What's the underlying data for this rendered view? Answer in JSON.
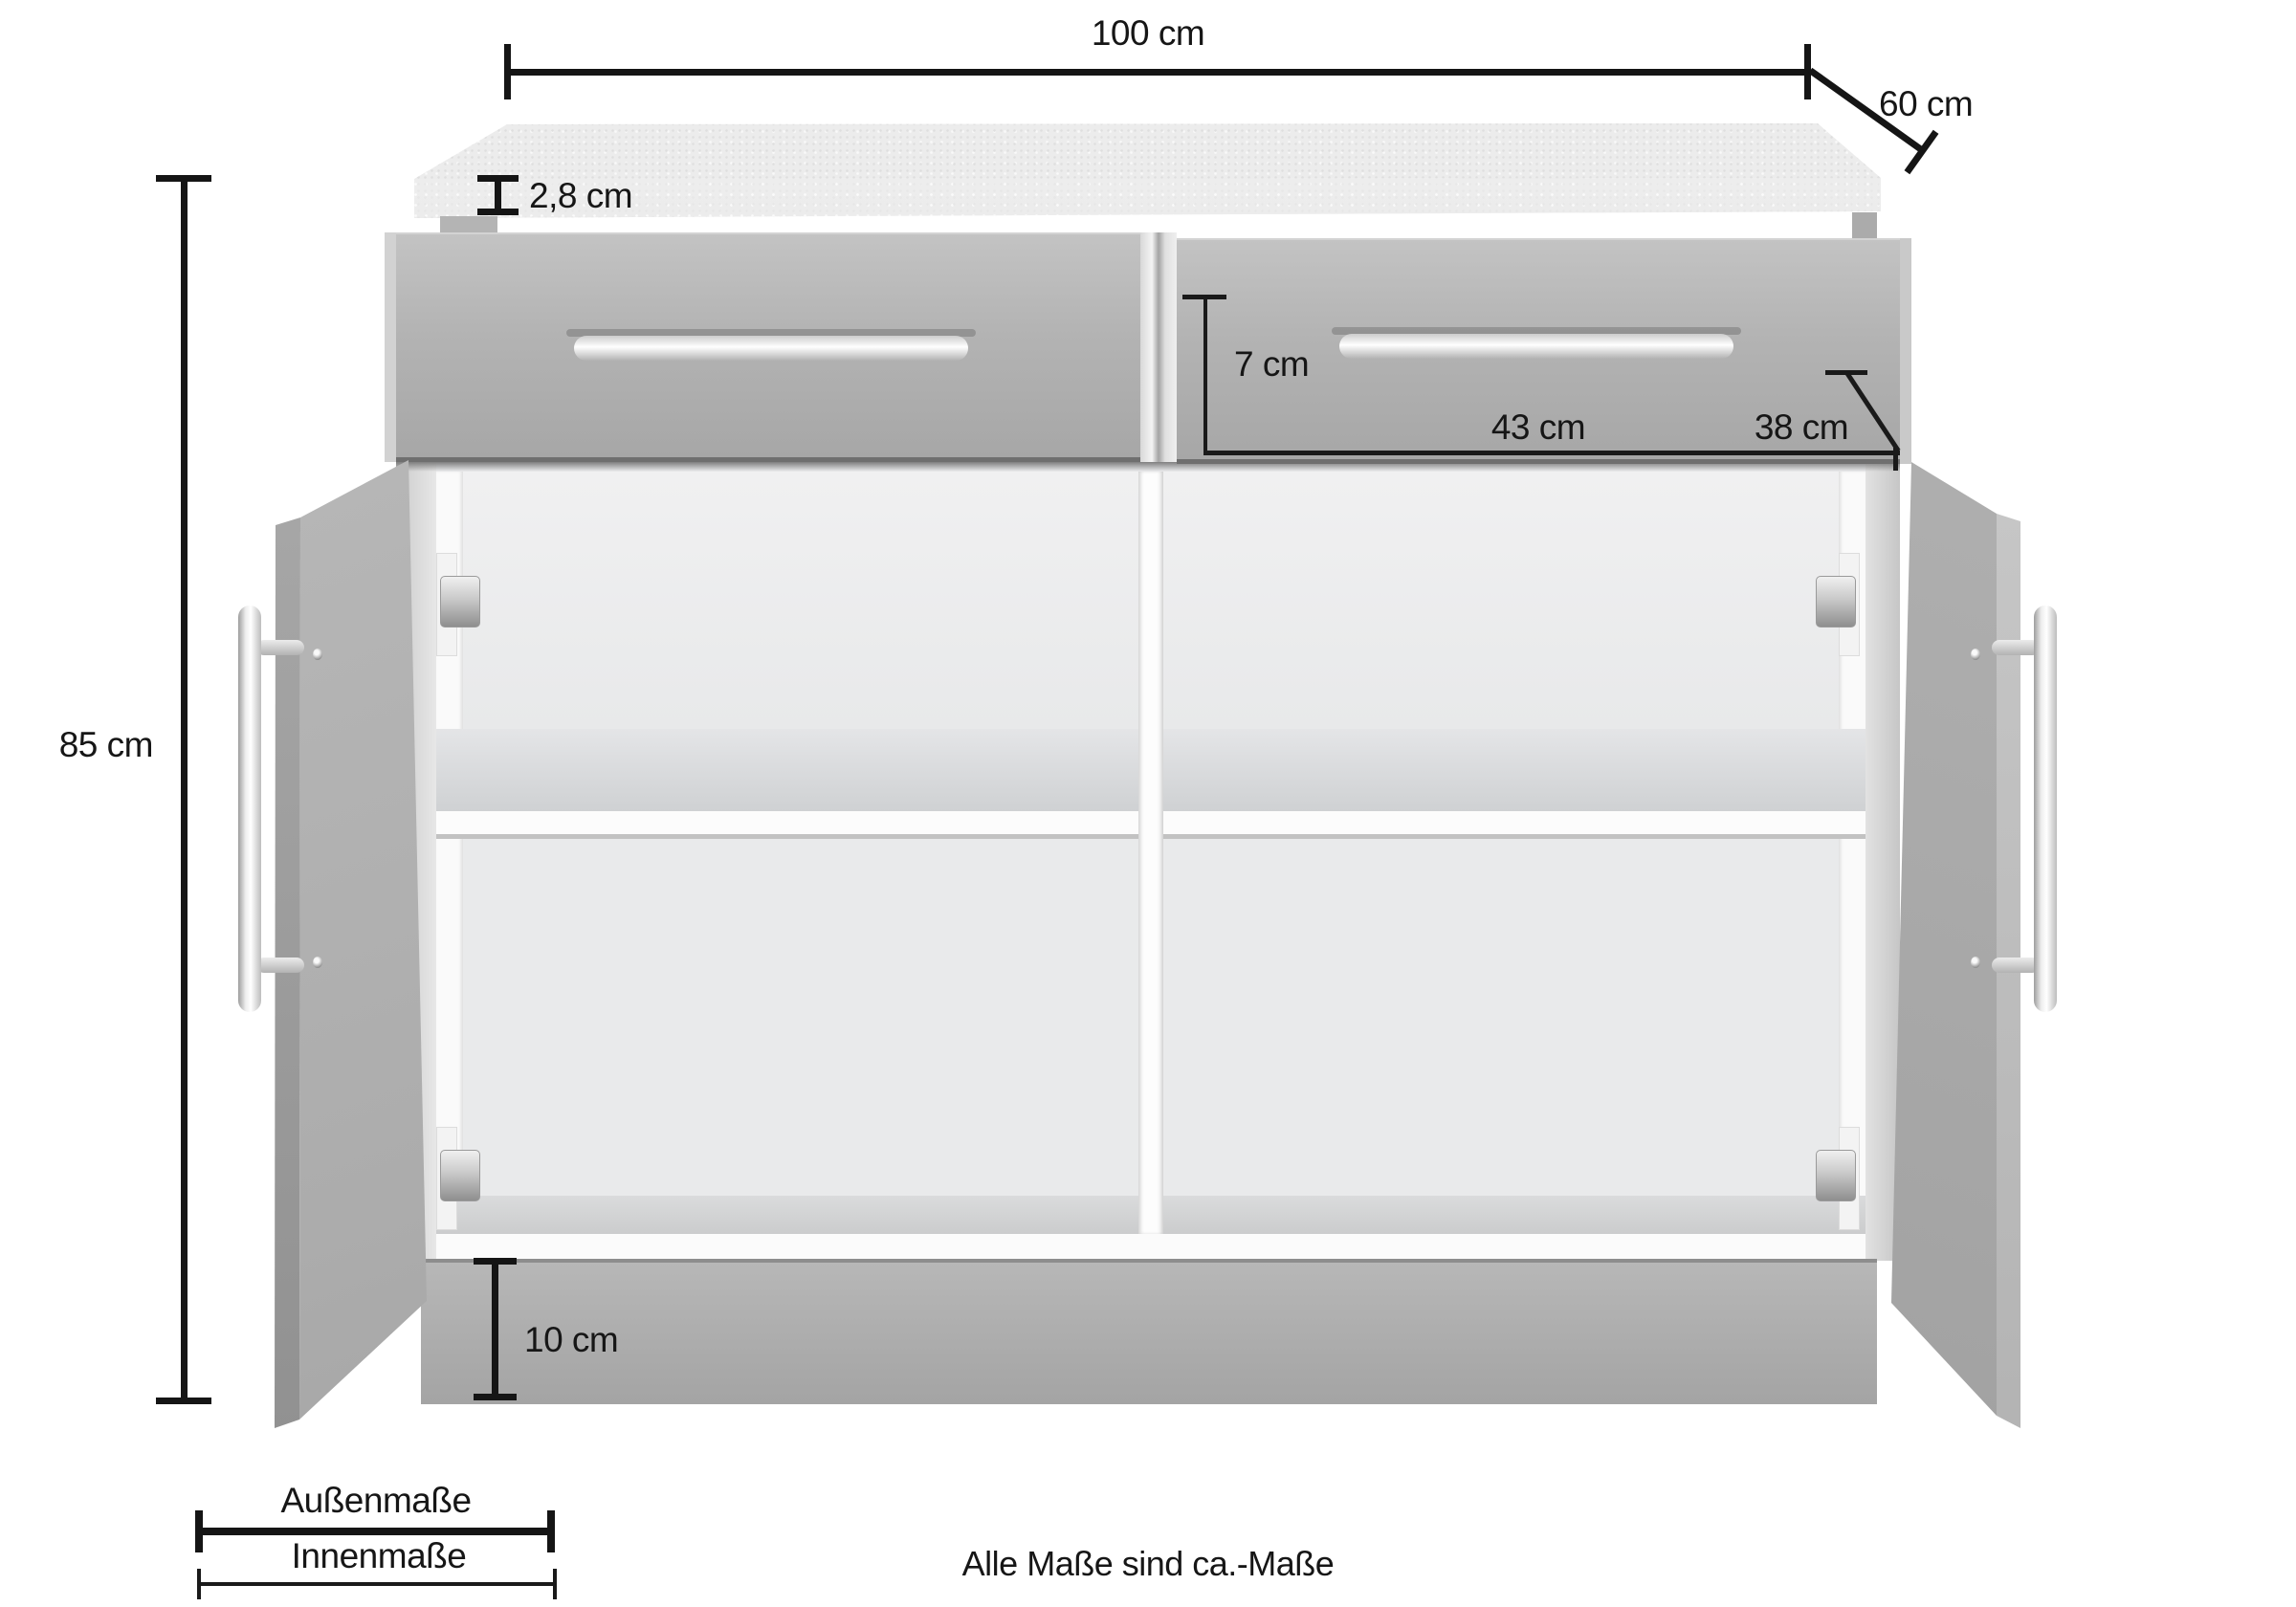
{
  "diagram": {
    "product": "kitchen-base-cabinet-dimension-diagram",
    "colors": {
      "background": "#ffffff",
      "dimension_lines": "#151515",
      "cabinet_front": "#b3b3b3",
      "countertop": "#ececec",
      "interior": "#ebecee"
    },
    "annotations": {
      "width": "100 cm",
      "depth": "60 cm",
      "height": "85 cm",
      "countertop_thickness": "2,8 cm",
      "drawer_inner_height": "7 cm",
      "drawer_inner_width": "43 cm",
      "drawer_inner_depth": "38 cm",
      "plinth_height": "10 cm"
    },
    "legend": {
      "outer_label": "Außenmaße",
      "inner_label": "Innenmaße"
    },
    "footnote": "Alle Maße sind ca.-Maße"
  }
}
